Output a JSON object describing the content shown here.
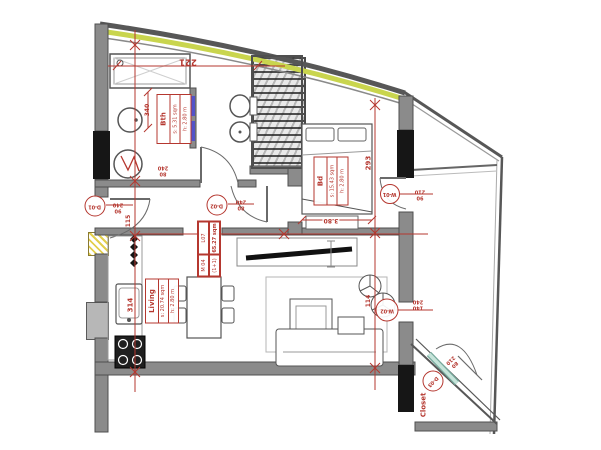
{
  "plan": {
    "unit": {
      "code": "L07",
      "area": "65.27 sqm",
      "model": "M 04",
      "scheme": "(1+1)"
    },
    "rooms": {
      "bath": {
        "name": "Bth",
        "area": "s: 5.31 sqm",
        "height": "h: 2.80 m"
      },
      "bedroom": {
        "name": "Bd",
        "area": "s: 15.43 sqm",
        "height": "h: 2.80 m"
      },
      "living": {
        "name": "Living",
        "area": "s: 20.74 sqm",
        "height": "h: 2.80 m"
      },
      "closet": {
        "name": "Closet"
      }
    },
    "openings": {
      "d01": {
        "id": "D-01",
        "w": "90",
        "h": "240"
      },
      "d02": {
        "id": "D-02",
        "w": "80",
        "h": "240"
      },
      "d03": {
        "id": "D-03",
        "w": "80",
        "h": "210"
      },
      "w01": {
        "id": "W-01",
        "w": "90",
        "h": "210"
      },
      "w02": {
        "id": "W-02",
        "w": "140",
        "h": "240"
      },
      "bath": {
        "w": "80",
        "h": "240"
      }
    },
    "dimensions": {
      "overall_top": "221",
      "bath": "340",
      "hall": "115",
      "kitchen": "314",
      "bedroom": "293",
      "bed": "3.80",
      "balcony": "114"
    },
    "colors": {
      "annotation_red": "#b5372f",
      "wall_gray": "#8b8b8b",
      "facade_band_yellow": "#c9d54e",
      "door_leaf_teal": "#c6e4da",
      "fixture_blue": "#5353c9"
    }
  }
}
